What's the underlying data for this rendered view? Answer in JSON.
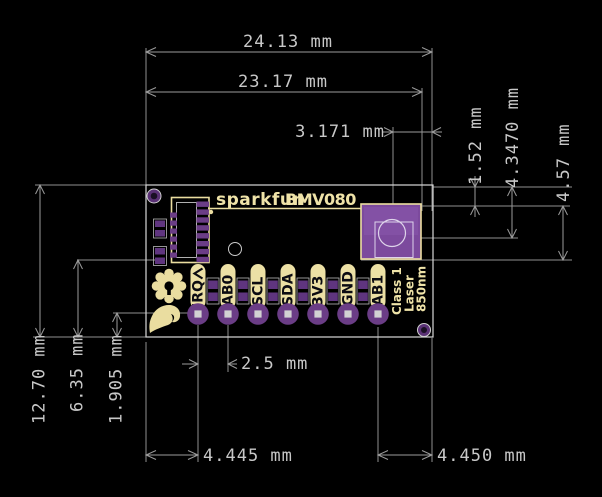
{
  "board": {
    "brand": "sparkfun",
    "product": "BMV080",
    "pin_labels": [
      "IRQ",
      "AB0",
      "SCL",
      "SDA",
      "3V3",
      "GND",
      "AB1"
    ],
    "laser_marking": [
      "Class 1",
      "Laser",
      "850nm"
    ]
  },
  "dimensions": {
    "overall_width": "24.13 mm",
    "inner_width": "23.17 mm",
    "sensor_center_to_right_edge": "3.171 mm",
    "top_edge_to_sensor_top": "1.52 mm",
    "top_edge_to_sensor_center": "4.3470 mm",
    "sensor_height": "4.57 mm",
    "overall_height": "12.70 mm",
    "centerline_from_bottom": "6.35 mm",
    "pin_row_from_bottom": "1.905 mm",
    "pin_pitch": "2.5 mm",
    "left_edge_to_first_pin": "4.445 mm",
    "last_pin_to_right_edge": "4.450 mm"
  },
  "colors": {
    "background": "#000000",
    "dimension_lines": "#9b9b9b",
    "dimension_text": "#c8c8c8",
    "board_outline": "#d8d8d8",
    "copper_pads": "#6b3d86",
    "sensor_body": "#7c4a9d",
    "silkscreen": "#efe3a8",
    "pin_label_text": "#0b0b12"
  }
}
